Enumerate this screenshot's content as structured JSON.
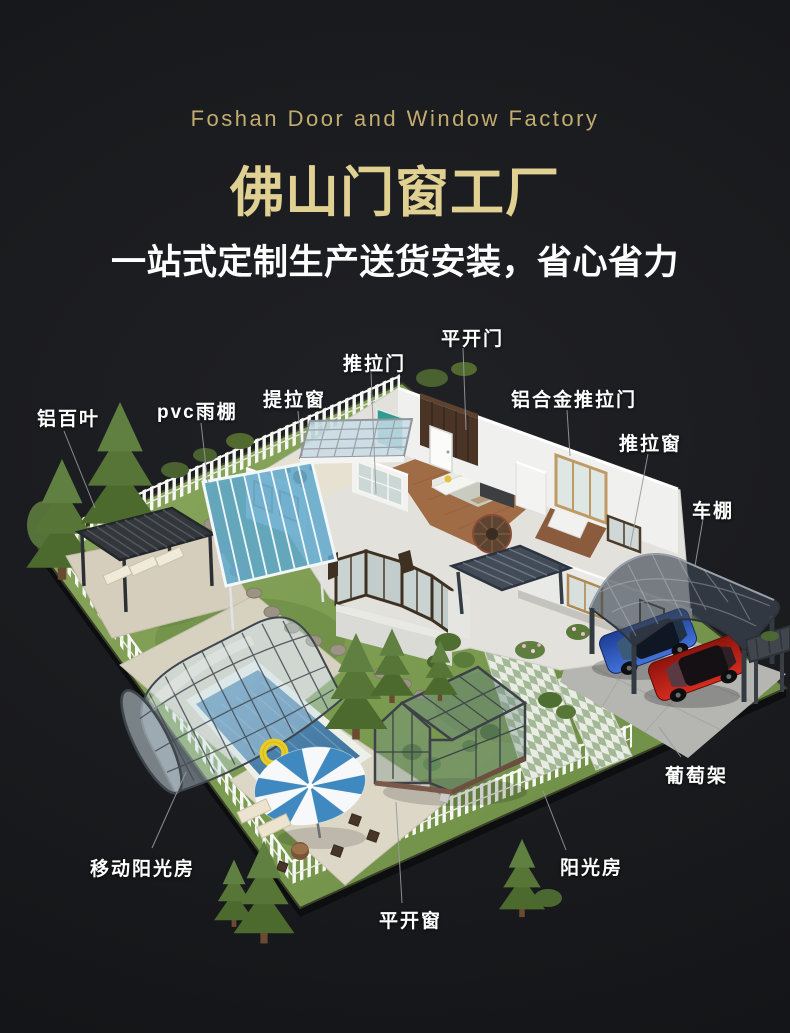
{
  "header": {
    "subtitle_en": "Foshan Door and Window Factory",
    "title": "佛山门窗工厂",
    "tagline": "一站式定制生产送货安装，省心省力"
  },
  "labels": {
    "aluminum_louver": "铝百叶",
    "pvc_canopy": "pvc雨棚",
    "lift_window": "提拉窗",
    "sliding_door": "推拉门",
    "casement_door": "平开门",
    "aluminum_sliding_door": "铝合金推拉门",
    "sliding_window": "推拉窗",
    "carport": "车棚",
    "grape_trellis": "葡萄架",
    "sunroom": "阳光房",
    "casement_window": "平开窗",
    "mobile_sunroom": "移动阳光房"
  },
  "colors": {
    "background": "#1a1b1e",
    "title_gold": "#e0d092",
    "subtitle_gold": "#c3ac6f",
    "label_white": "#ffffff",
    "lawn_green": "#7d9c52",
    "pool_blue": "#4a80a8",
    "canopy_blue": "#5fa8cc",
    "umbrella_blue": "#4089c0",
    "car_blue": "#3564cc",
    "car_red": "#c4231a",
    "structure_dark": "#3a3e44"
  }
}
